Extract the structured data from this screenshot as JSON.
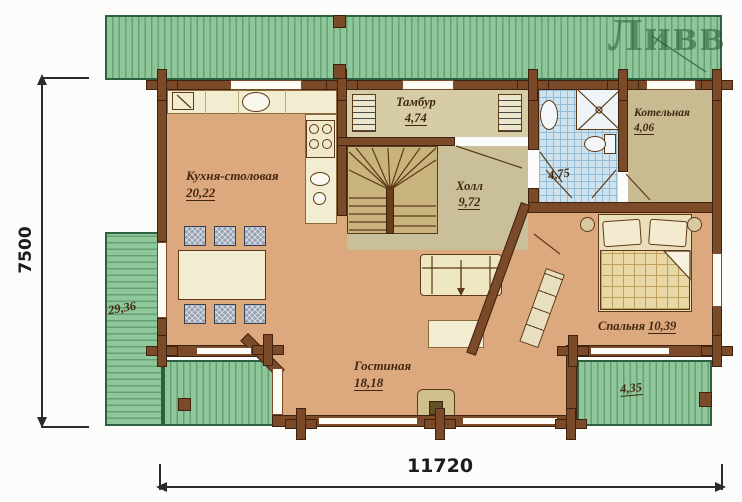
{
  "watermark": {
    "text": "Ливв"
  },
  "dimensions": {
    "height_mm": "7500",
    "width_mm": "11720"
  },
  "rooms": {
    "kitchen": {
      "name": "Кухня-столовая",
      "area": "20,22"
    },
    "vestibule": {
      "name": "Тамбур",
      "area": "4,74"
    },
    "hall": {
      "name": "Холл",
      "area": "9,72"
    },
    "bathroom": {
      "area": "4,75"
    },
    "boiler": {
      "name": "Котельная",
      "area": "4,06"
    },
    "bedroom": {
      "name": "Спальня",
      "area": "10,39"
    },
    "living": {
      "name": "Гостиная",
      "area": "18,18"
    },
    "terrace_left": {
      "area": "29,36"
    },
    "terrace_right": {
      "area": "4,35"
    }
  },
  "colors": {
    "wall": "#7b4a29",
    "floor_main": "#dca87e",
    "floor_hall": "#c9c099",
    "floor_boiler": "#c8bb92",
    "bath_tile": "#cfe3ee",
    "terrace_green": "#8ec79a",
    "counter_cream": "#f2ecd0",
    "label_text": "#42280f"
  }
}
